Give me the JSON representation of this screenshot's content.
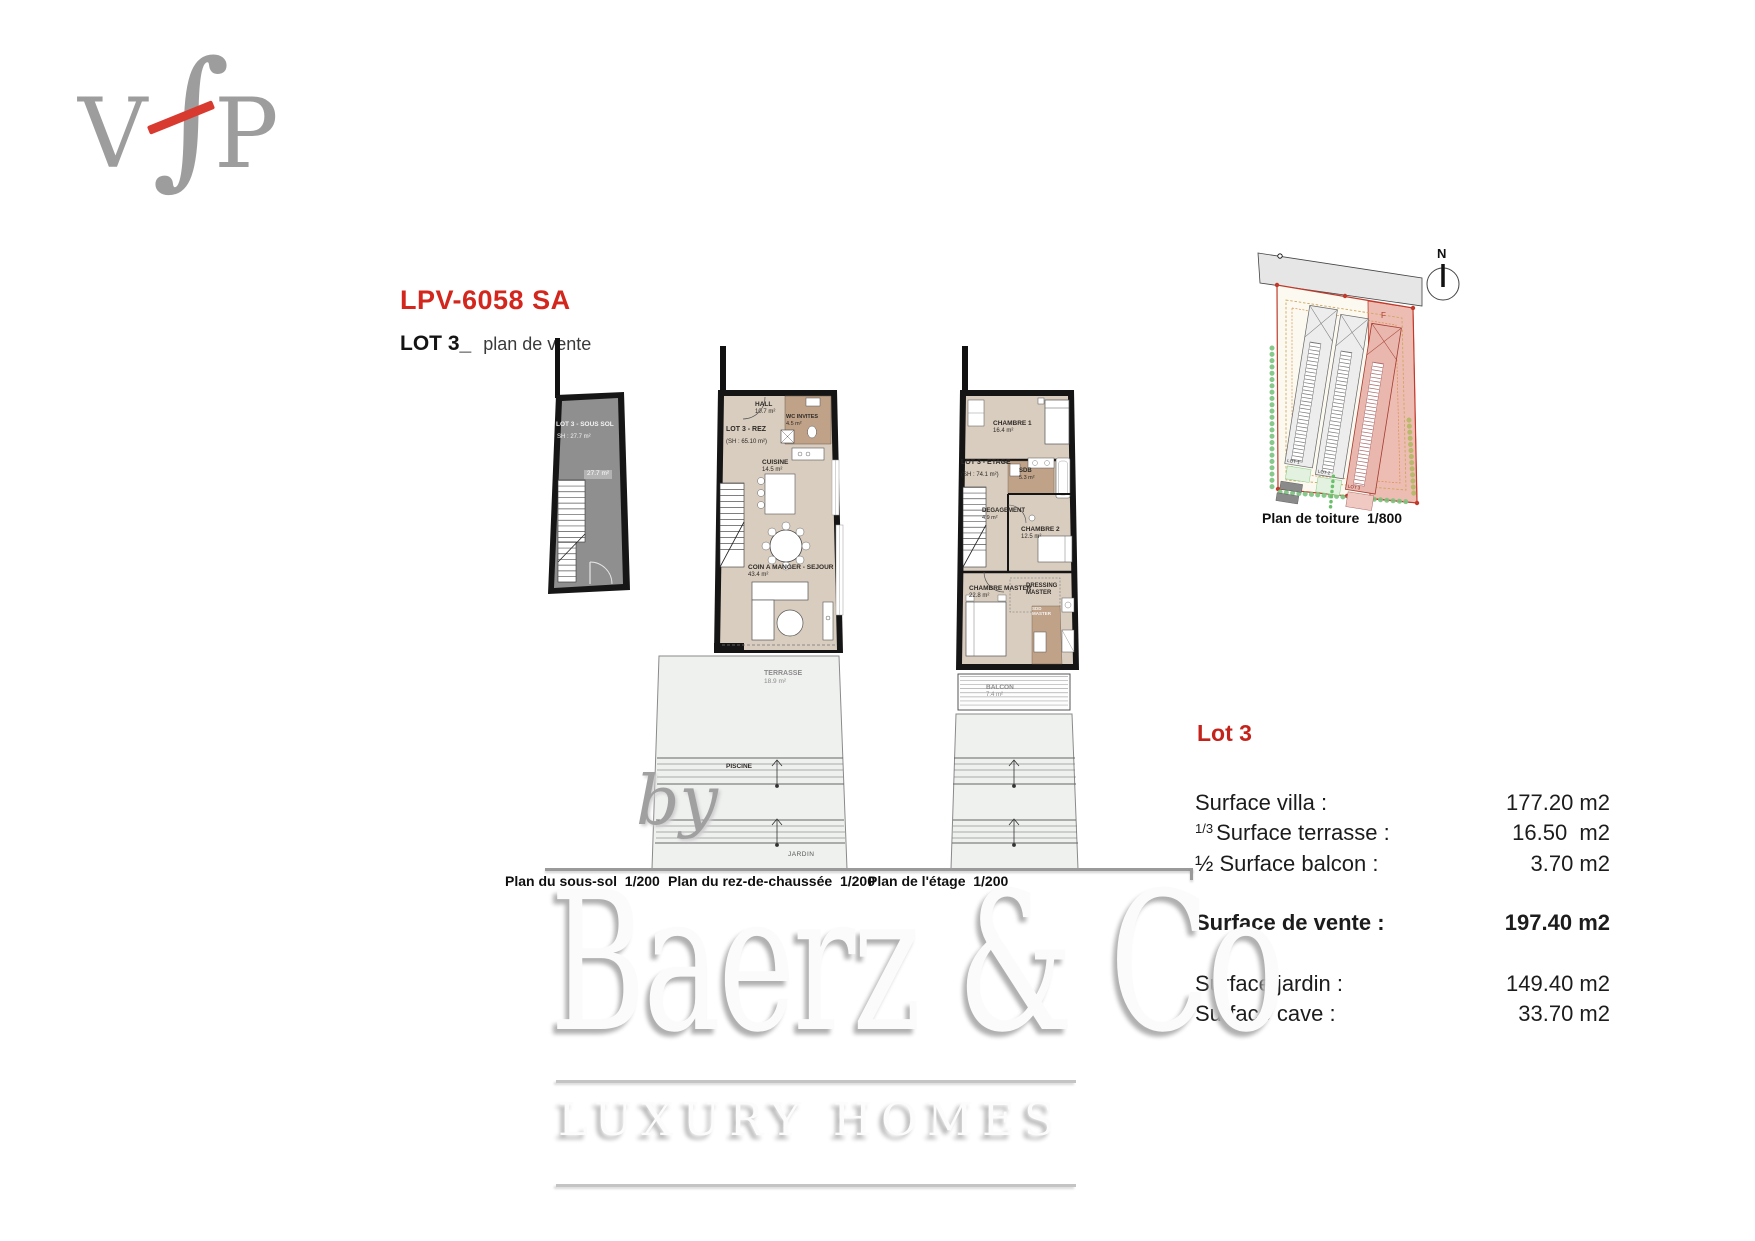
{
  "logo": {
    "letter_v": "V",
    "letter_f": "∫",
    "letter_p": "P"
  },
  "header": {
    "title": "LPV-6058 SA",
    "lot_label": "LOT 3_",
    "subtitle": "plan de vente"
  },
  "plans": {
    "basement": {
      "caption": "Plan du sous-sol  1/200",
      "room_label": "LOT 3 - SOUS SOL",
      "sh_label": "SH : 27.7 m²",
      "area_tag": "27.7 m²"
    },
    "ground": {
      "caption": "Plan du rez-de-chaussée  1/200",
      "lot_label": "LOT 3 - REZ",
      "sh_label": "(SH : 65.10 m²)",
      "hall_name": "HALL",
      "hall_area": "10.7 m²",
      "wc_name": "WC INVITES",
      "wc_area": "4.5 m²",
      "kitchen_name": "CUISINE",
      "kitchen_area": "14.5 m²",
      "living_name": "COIN A MANGER - SEJOUR",
      "living_area": "43.4 m²",
      "terrace_name": "TERRASSE",
      "terrace_area": "18.9 m²",
      "pool_name": "PISCINE",
      "garden_name": "JARDIN"
    },
    "upper": {
      "caption": "Plan de l'étage  1/200",
      "lot_label": "LOT 3 - ETAGE",
      "sh_label": "(SH : 74.1 m²)",
      "bedroom1_name": "CHAMBRE 1",
      "bedroom1_area": "16.4 m²",
      "bath_name": "SDB",
      "bath_area": "5.3 m²",
      "hallway_name": "DEGAGEMENT",
      "hallway_area": "4.9 m²",
      "bedroom2_name": "CHAMBRE 2",
      "bedroom2_area": "12.5 m²",
      "master_name": "CHAMBRE MASTER",
      "master_area": "22.8 m²",
      "dressing_name": "DRESSING",
      "dressing_name2": "MASTER",
      "shower_name": "SDD",
      "shower_name2": "MASTER",
      "balcony_name": "BALCON",
      "balcony_area": "7.4 m²"
    },
    "roof": {
      "caption": "Plan de toiture  1/800",
      "compass": "N",
      "f_label": "F",
      "lot1": "LOT 1",
      "lot2": "LOT 2",
      "lot3": "LOT 3"
    }
  },
  "surfaces": {
    "title": "Lot 3",
    "rows": [
      {
        "label": "Surface villa :",
        "value": "177.20 m2"
      },
      {
        "sup": "1/3",
        "label": "Surface terrasse :",
        "value": "16.50  m2"
      },
      {
        "label": "½ Surface balcon :",
        "value": "3.70 m2"
      },
      {
        "label": "Surface de vente :",
        "value": "197.40 m2"
      },
      {
        "label": "Surface jardin :",
        "value": "149.40 m2"
      },
      {
        "label": "Surface cave :",
        "value": "33.70 m2"
      }
    ]
  },
  "watermark": {
    "by": "by",
    "brand": "Baerz & Co",
    "tagline": "LUXURY HOMES"
  },
  "colors": {
    "accent_red": "#d3271e",
    "floor_beige": "#d9cdbf",
    "wet_room_brown": "#bfa288",
    "basement_gray": "#8f8f8f",
    "plot_red": "#c0392b"
  }
}
